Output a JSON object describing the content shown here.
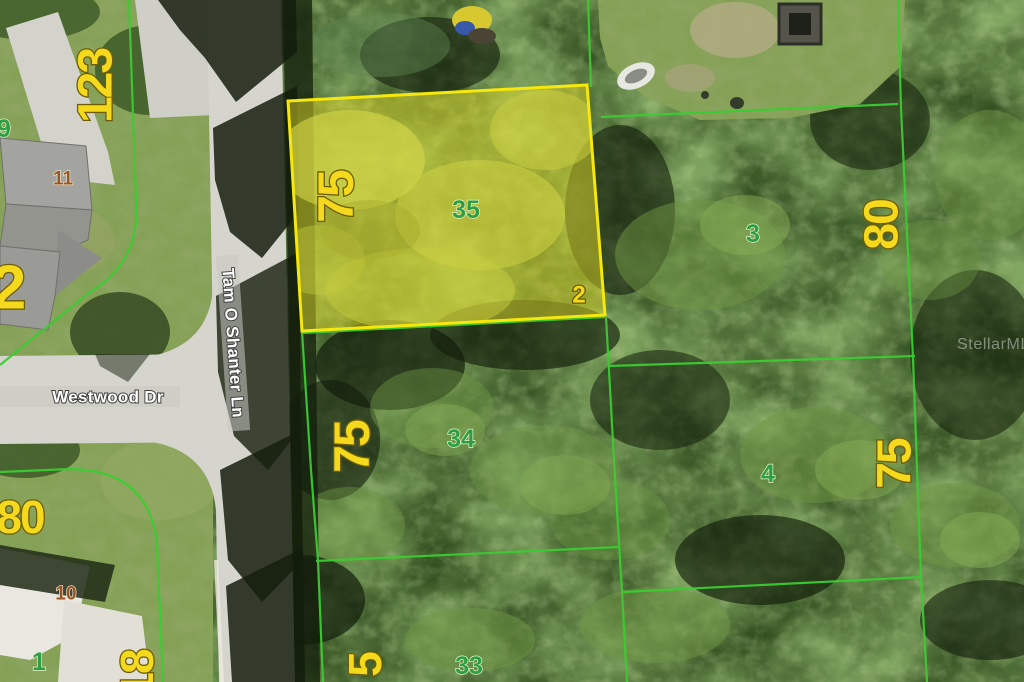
{
  "source": {
    "watermark": "StellarMLS"
  },
  "streets": {
    "westwood": "Westwood Dr",
    "tam_o_shanter": "Tam O Shanter Ln"
  },
  "highlighted_parcel": {
    "lot_number": "35",
    "frontage_ft": "75",
    "block_tag": "2"
  },
  "lot_numbers": {
    "lot_9": "9",
    "lot_11": "11",
    "lot_10": "10",
    "lot_1": "1",
    "lot_33": "33",
    "lot_34": "34",
    "lot_3": "3",
    "lot_4": "4"
  },
  "dimensions": {
    "dim_123": "123",
    "dim_2_left": "2",
    "dim_80_right": "80",
    "dim_75_lot34": "75",
    "dim_75_lot4": "75",
    "dim_80_bottom_left": "80",
    "dim_18_partial": "18",
    "dim_5_partial": "5"
  },
  "colors": {
    "parcel_line_green": "#3ccb33",
    "highlight_yellow": "#f6e70d",
    "highlight_fill": "rgba(233,224,39,0.48)",
    "dimension_text_yellow": "#f4d91c",
    "lot_text_green": "#2e9e44",
    "address_text_brown": "#96562a"
  }
}
